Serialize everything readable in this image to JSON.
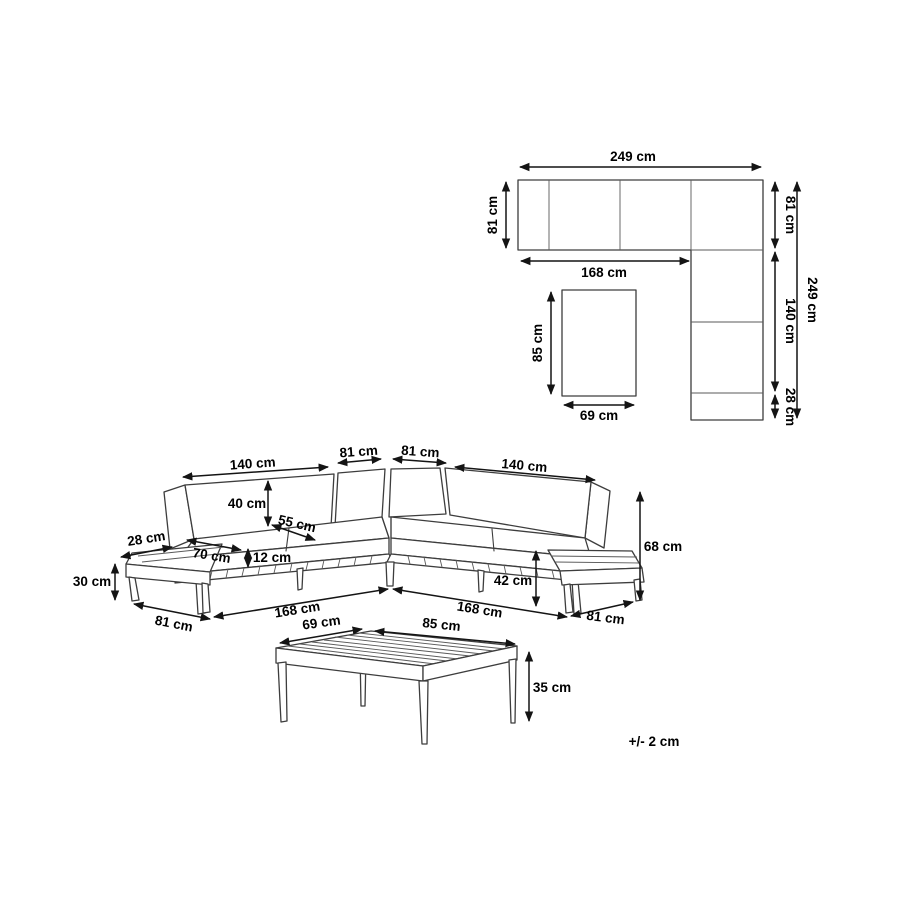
{
  "diagram": {
    "colors": {
      "background": "#ffffff",
      "line": "#3d3d3d",
      "dimension": "#141414",
      "text": "#000000"
    },
    "plan": {
      "total_width": "249 cm",
      "side_depth": "81 cm",
      "inner_width": "168 cm",
      "corner_depth": "81 cm",
      "right_length": "140 cm",
      "right_end": "28 cm",
      "total_depth": "249 cm",
      "table_depth": "85 cm",
      "table_width": "69 cm"
    },
    "sofa": {
      "left_module": "140 cm",
      "corner_left": "81 cm",
      "corner_right": "81 cm",
      "right_module": "140 cm",
      "backrest_height": "40 cm",
      "seat_depth": "55 cm",
      "cushion_width": "70 cm",
      "cushion_thickness": "12 cm",
      "end_shelf_depth": "28 cm",
      "end_shelf_height": "30 cm",
      "left_end_depth": "81 cm",
      "left_length": "168 cm",
      "right_length": "168 cm",
      "seat_height": "42 cm",
      "total_height": "68 cm",
      "right_end_depth": "81 cm"
    },
    "table": {
      "width": "69 cm",
      "length": "85 cm",
      "height": "35 cm"
    },
    "tolerance": "+/- 2 cm"
  }
}
